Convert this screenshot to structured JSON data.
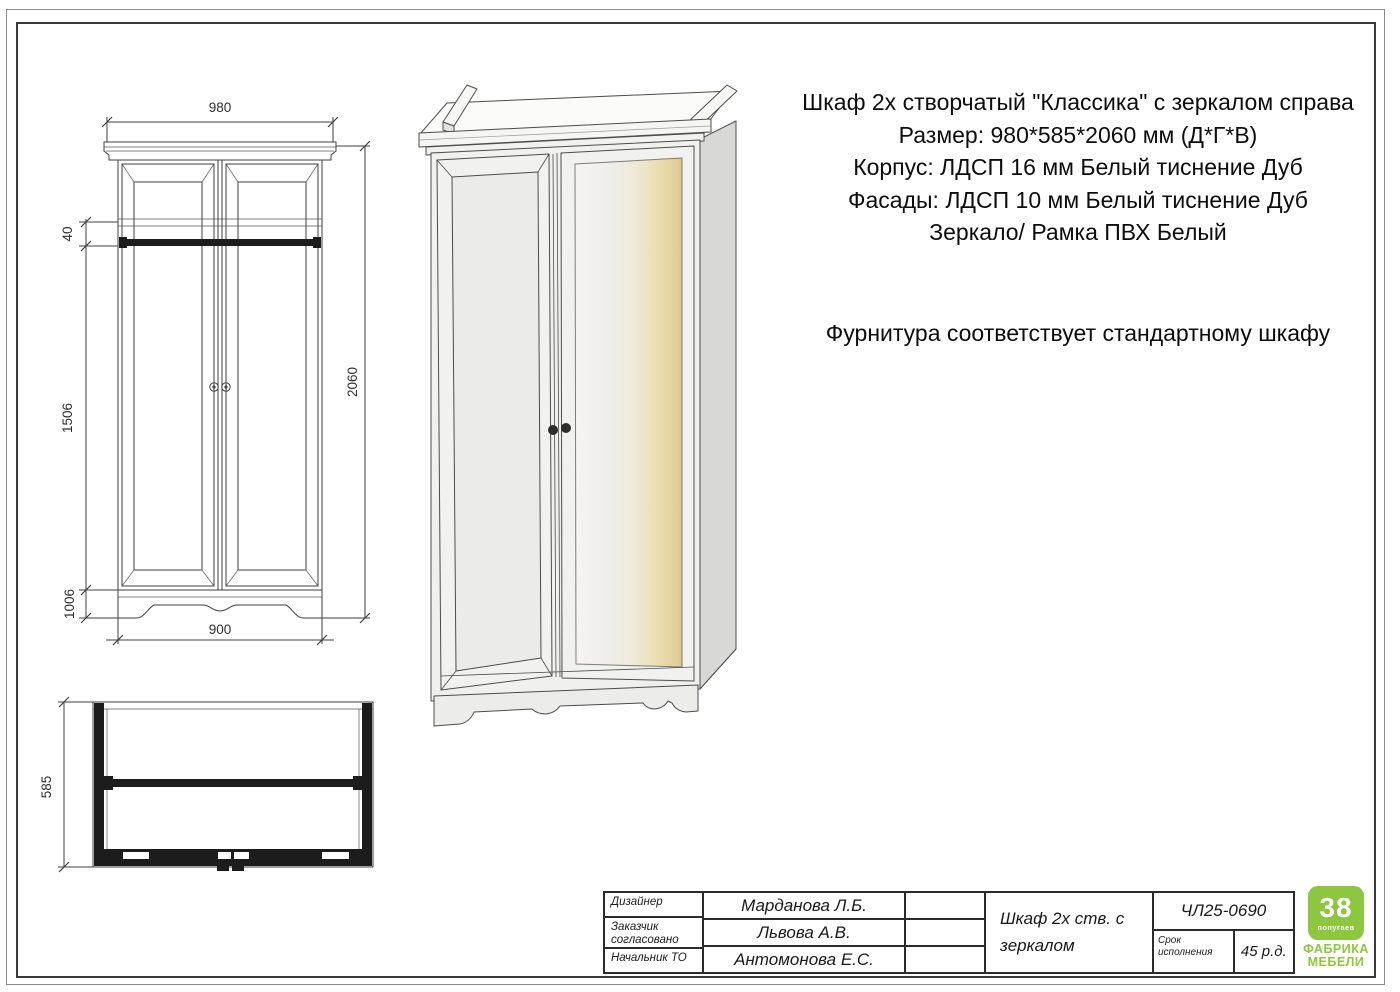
{
  "spec": {
    "lines": [
      "Шкаф 2х створчатый \"Классика\" с зеркалом справа",
      "Размер: 980*585*2060 мм (Д*Г*В)",
      "Корпус: ЛДСП 16 мм Белый тиснение Дуб",
      "Фасады: ЛДСП 10 мм Белый тиснение Дуб",
      "Зеркало/ Рамка ПВХ Белый"
    ],
    "hardware_note": "Фурнитура соответствует стандартному шкафу"
  },
  "dims": {
    "front": {
      "width_top": "980",
      "rail_gap": "40",
      "door_height": "1506",
      "plinth": "1006",
      "width_bottom": "900",
      "height": "2060"
    },
    "top_view": {
      "depth": "585"
    }
  },
  "title_block": {
    "rows": [
      {
        "label": "Дизайнер",
        "value": "Марданова Л.Б."
      },
      {
        "label": "Заказчик согласовано",
        "value": "Львова А.В."
      },
      {
        "label": "Начальник ТО",
        "value": "Антомонова Е.С."
      }
    ],
    "product": "Шкаф 2х ств. с зеркалом",
    "code": "ЧЛ25-0690",
    "deadline_label": "Срок исполнения",
    "deadline_value": "45 р.д."
  },
  "logo": {
    "number": "38",
    "sub": "попугаев",
    "line1": "ФАБРИКА",
    "line2": "МЕБЕЛИ",
    "green": "#8dc63f"
  }
}
